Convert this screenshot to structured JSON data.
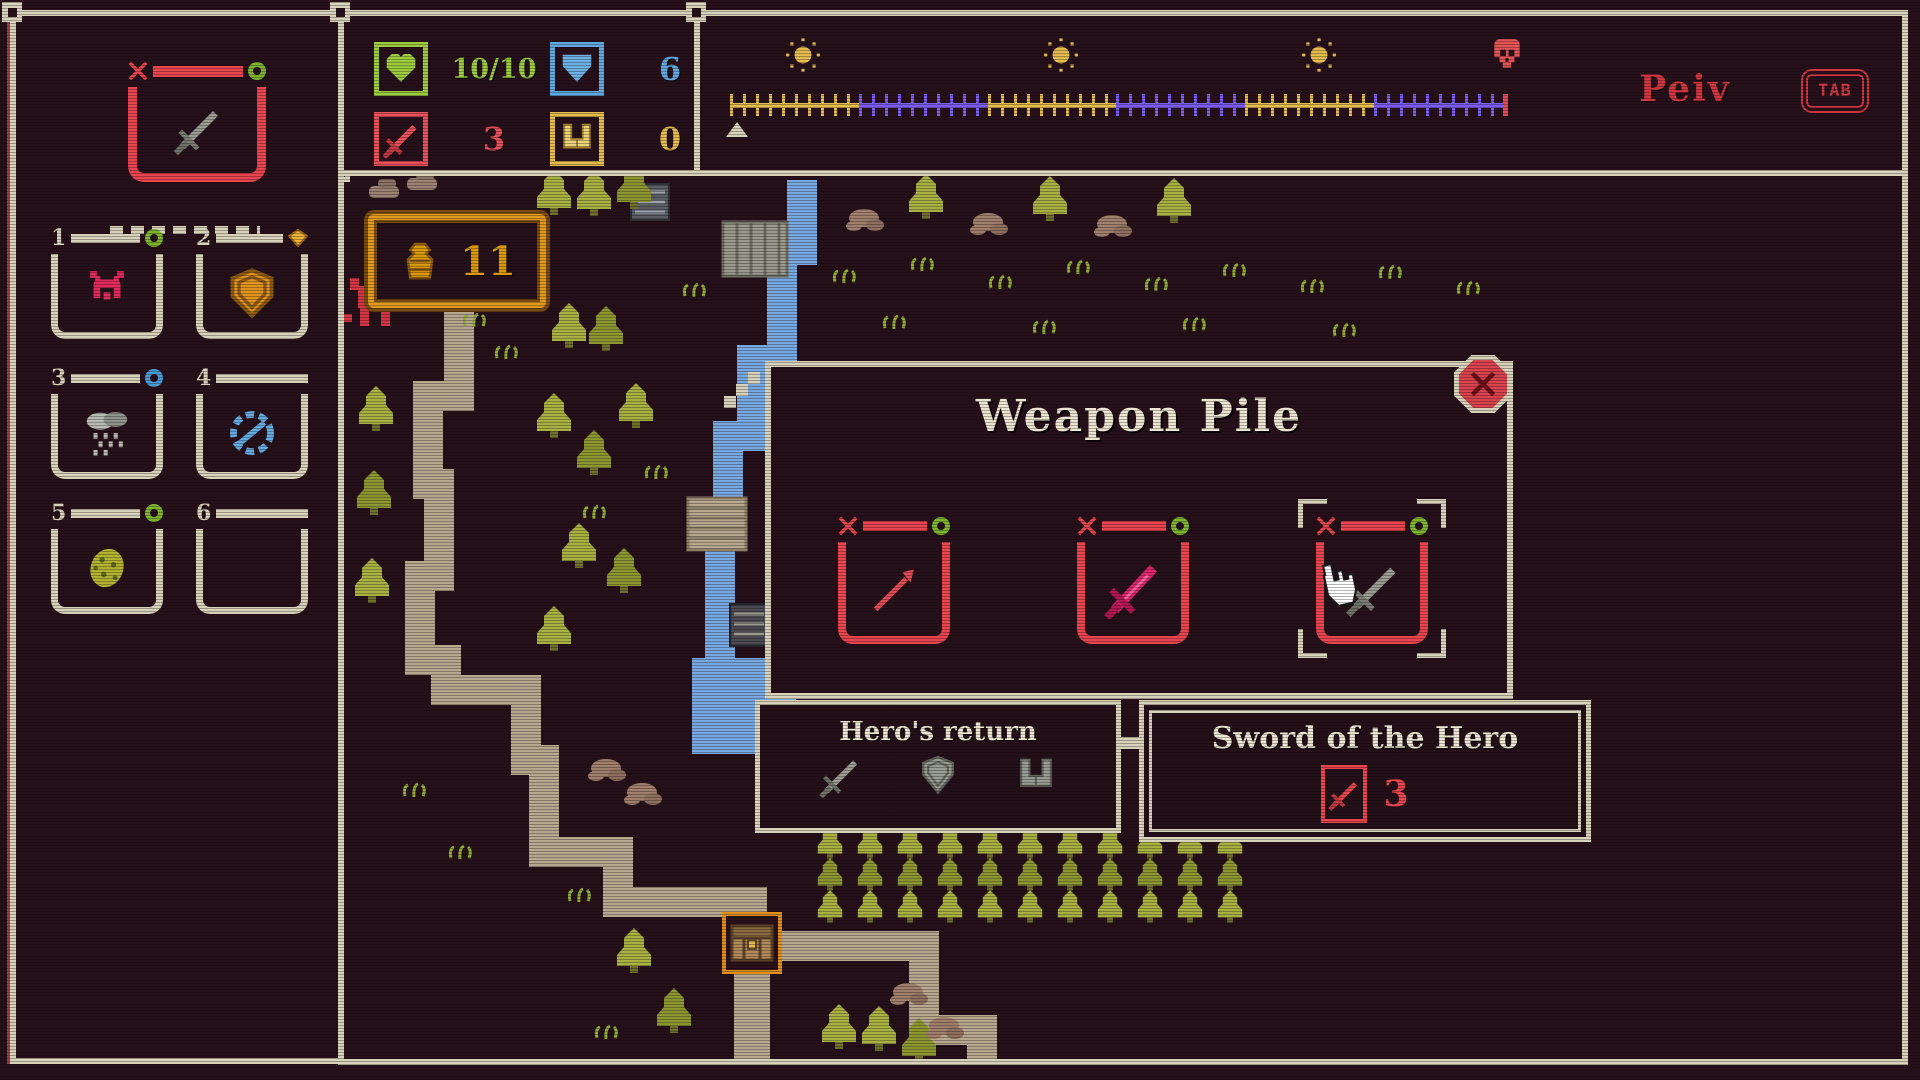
{
  "colors": {
    "background": "#261019",
    "frame_cream": "#d8d2ba",
    "ui_red": "#e8454f",
    "deep_red": "#cf3640",
    "green": "#9ccb3f",
    "ring_green": "#7db52f",
    "blue": "#5fa8e0",
    "gold": "#e3bb4e",
    "orange": "#e09a1f",
    "night_purple": "#7a5df0",
    "pink": "#e0256d",
    "grey": "#9a9d93",
    "white_text": "#ece5d2",
    "path_tan": "#b7a78f",
    "water_blue": "#78a8e0",
    "tree_light": "#a9b042",
    "tree_dark": "#8d9732"
  },
  "hud": {
    "equipped_slot": {
      "item": "grey-sword",
      "badge": "green-ring"
    },
    "stats": [
      {
        "name": "health",
        "icon": "heart-icon",
        "value": "10/10"
      },
      {
        "name": "defense",
        "icon": "shield-icon",
        "value": "6"
      },
      {
        "name": "attack",
        "icon": "sword-icon",
        "value": "3"
      },
      {
        "name": "boots",
        "icon": "boots-icon",
        "value": "0"
      }
    ],
    "timeline": {
      "sequence": [
        "sun",
        "moon",
        "sun",
        "moon",
        "sun",
        "moon",
        "skull"
      ],
      "segments": [
        "day",
        "night",
        "day",
        "night",
        "day",
        "night"
      ]
    },
    "player_name": "Peiv",
    "key_hint": "TAB"
  },
  "inventory": {
    "slots": [
      {
        "number": "1",
        "item": "horned-helmet",
        "badge": "green-ring"
      },
      {
        "number": "2",
        "item": "orange-shield",
        "badge": "gem"
      },
      {
        "number": "3",
        "item": "rain-cloud",
        "badge": "blue-ring"
      },
      {
        "number": "4",
        "item": "compass",
        "badge": null
      },
      {
        "number": "5",
        "item": "beetle",
        "badge": "green-ring"
      },
      {
        "number": "6",
        "item": null,
        "badge": null
      }
    ]
  },
  "map": {
    "gold_count": "11",
    "objects": [
      "treasure-chest",
      "hero-marker"
    ]
  },
  "dialog": {
    "title": "Weapon Pile",
    "slots": [
      {
        "item": "red-spear",
        "badge": "green-ring",
        "selected": false
      },
      {
        "item": "pink-sword",
        "badge": "green-ring",
        "selected": false
      },
      {
        "item": "grey-sword",
        "badge": "green-ring",
        "selected": true
      }
    ]
  },
  "tooltips": {
    "left": {
      "title": "Hero's return",
      "icons": [
        "sword-icon",
        "shield-icon",
        "boots-icon"
      ]
    },
    "right": {
      "title": "Sword of the Hero",
      "stat_icon": "sword-icon",
      "stat_value": "3"
    }
  }
}
